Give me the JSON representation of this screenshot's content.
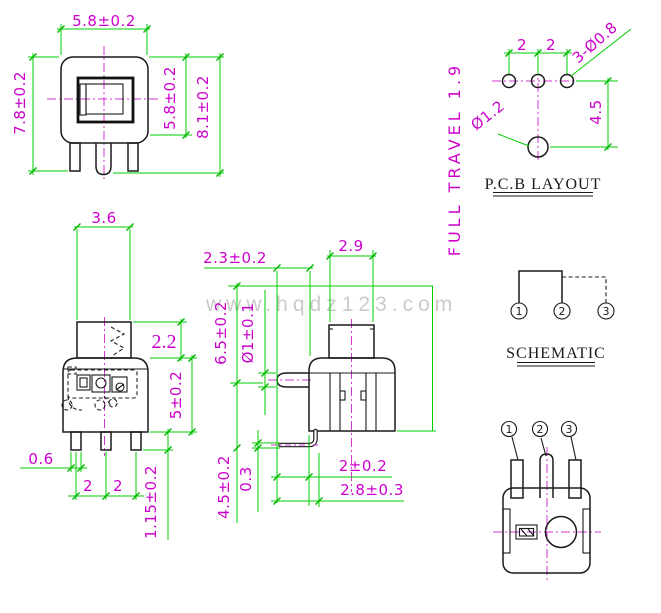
{
  "watermark": "www.hqdz123.com",
  "full_travel_note": "FULL TRAVEL 1.9",
  "top_front_view": {
    "dim_width_top": "5.8±0.2",
    "dim_height_left": "7.8±0.2",
    "dim_body_height": "5.8±0.2",
    "dim_total_height": "8.1±0.2"
  },
  "pcb_layout": {
    "title": "P.C.B LAYOUT",
    "dim_pitch_left": "2",
    "dim_pitch_right": "2",
    "hole_callout": "3-Ø0.8",
    "center_hole_callout": "Ø1.2",
    "dim_row_offset": "4.5"
  },
  "front_view": {
    "dim_button_width": "3.6",
    "dim_button_height": "2.2",
    "dim_body_height": "5±0.2",
    "dim_pin_width": "0.6",
    "dim_pitch_left": "2",
    "dim_pitch_right": "2",
    "dim_pin_length": "1.15±0.2"
  },
  "side_view": {
    "dim_pin_protrusion": "2.3±0.2",
    "dim_button_width": "2.9",
    "dim_overall_height": "6.5±0.2",
    "dim_pin_diameter": "Ø1±0.1",
    "dim_lower_height": "4.5±0.2",
    "dim_wire_thickness": "0.3",
    "dim_wire_inset": "2±0.2",
    "dim_wire_span": "2.8±0.3"
  },
  "schematic": {
    "title": "SCHEMATIC",
    "pin_labels": [
      "1",
      "2",
      "3"
    ]
  },
  "bottom_view": {
    "pin_labels": [
      "1",
      "2",
      "3"
    ]
  }
}
